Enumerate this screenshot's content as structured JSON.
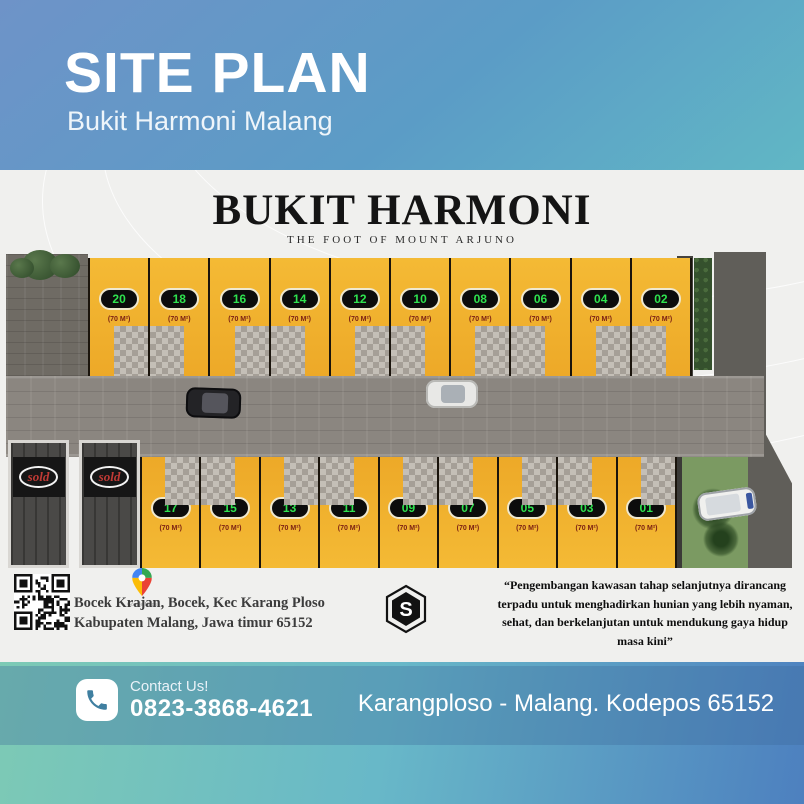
{
  "header": {
    "title": "SITE PLAN",
    "subtitle": "Bukit Harmoni Malang"
  },
  "card": {
    "brand": "BUKIT HARMONI",
    "tagline": "THE FOOT OF MOUNT ARJUNO"
  },
  "siteplan": {
    "top_row": [
      {
        "num": "20",
        "area": "(70 M²)"
      },
      {
        "num": "18",
        "area": "(70 M²)"
      },
      {
        "num": "16",
        "area": "(70 M²)"
      },
      {
        "num": "14",
        "area": "(70 M²)"
      },
      {
        "num": "12",
        "area": "(70 M²)"
      },
      {
        "num": "10",
        "area": "(70 M²)"
      },
      {
        "num": "08",
        "area": "(70 M²)"
      },
      {
        "num": "06",
        "area": "(70 M²)"
      },
      {
        "num": "04",
        "area": "(70 M²)"
      },
      {
        "num": "02",
        "area": "(70 M²)"
      }
    ],
    "bottom_row": [
      {
        "num": "17",
        "area": "(70 M²)"
      },
      {
        "num": "15",
        "area": "(70 M²)"
      },
      {
        "num": "13",
        "area": "(70 M²)"
      },
      {
        "num": "11",
        "area": "(70 M²)"
      },
      {
        "num": "09",
        "area": "(70 M²)"
      },
      {
        "num": "07",
        "area": "(70 M²)"
      },
      {
        "num": "05",
        "area": "(70 M²)"
      },
      {
        "num": "03",
        "area": "(70 M²)"
      },
      {
        "num": "01",
        "area": "(70 M²)"
      }
    ],
    "sold_signs": [
      "sold",
      "sold"
    ]
  },
  "info": {
    "maps_caption": "Google Maps",
    "address_line1": "Bocek Krajan, Bocek, Kec Karang Ploso",
    "address_line2": "Kabupaten Malang, Jawa timur 65152",
    "logo_letter": "S",
    "quote": "“Pengembangan kawasan tahap selanjutnya dirancang terpadu untuk menghadirkan hunian yang lebih nyaman, sehat, dan berkelanjutan untuk mendukung gaya hidup masa kini”"
  },
  "footer": {
    "contact_label": "Contact Us!",
    "phone": "0823-3868-4621",
    "location": "Karangploso - Malang. Kodepos 65152"
  },
  "colors": {
    "lot_yellow": "#F1B32C",
    "badge_green": "#2FE34F",
    "sold_red": "#C03A35"
  }
}
